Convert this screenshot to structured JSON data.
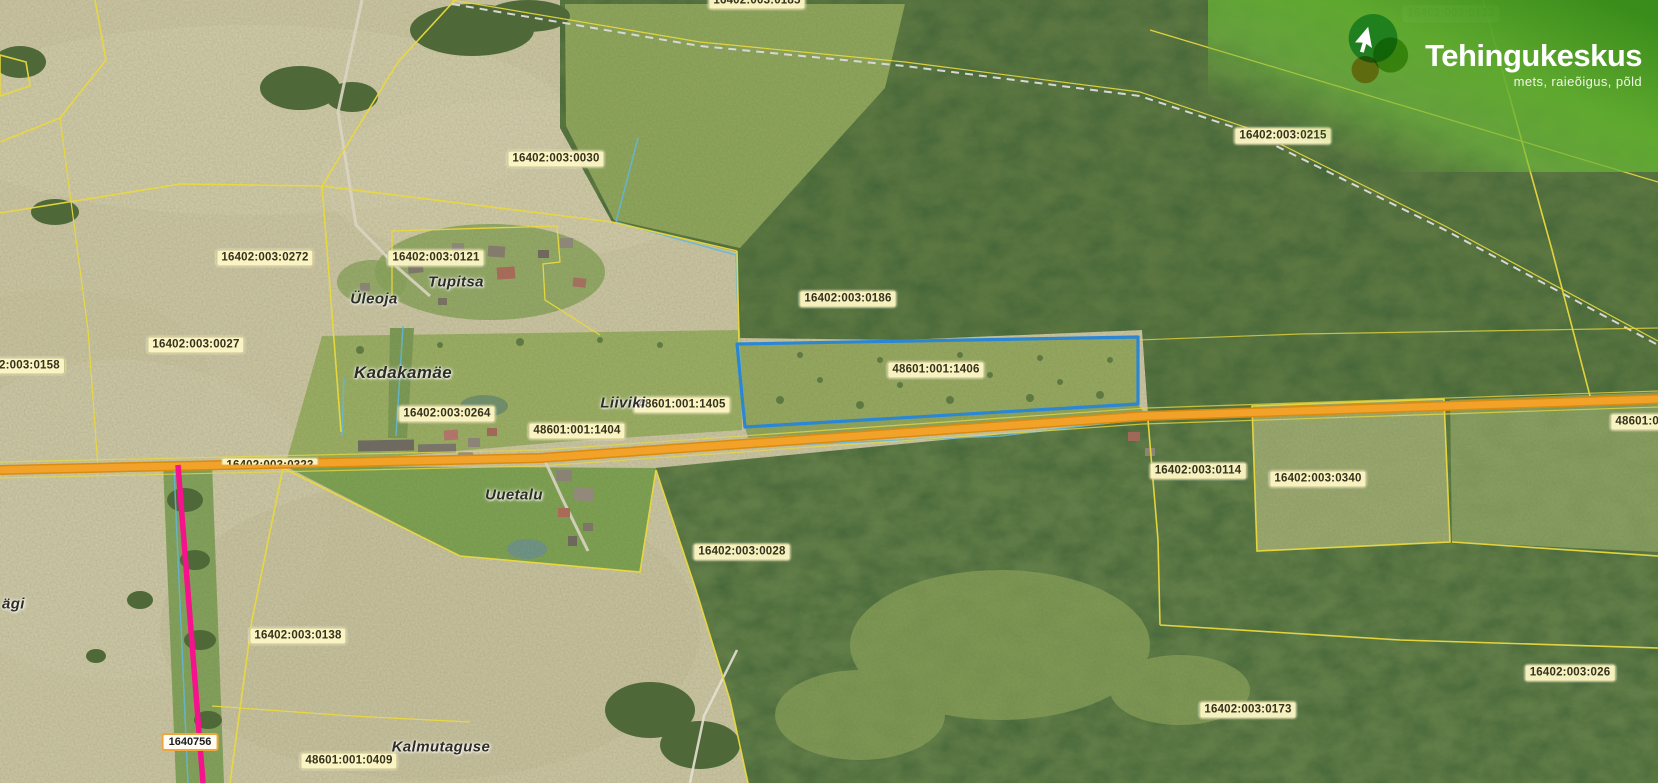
{
  "brand": {
    "name": "Tehingukeskus",
    "tagline": "mets, raieõigus, põld",
    "logo_icon": "cursor-in-circles",
    "logo_colors": {
      "teal": "#54c39a",
      "green": "#8fc93f",
      "orange": "#f2a93b"
    }
  },
  "labels": {
    "parcels": [
      {
        "text": "16402:003:0185",
        "x": 757,
        "y": 1,
        "v": "cut-top"
      },
      {
        "text": "16402:003:0133",
        "x": 1451,
        "y": 14,
        "v": "faded"
      },
      {
        "text": "16402:003:0215",
        "x": 1283,
        "y": 136
      },
      {
        "text": "16402:003:0030",
        "x": 556,
        "y": 159
      },
      {
        "text": "16402:003:0272",
        "x": 265,
        "y": 258
      },
      {
        "text": "16402:003:0121",
        "x": 436,
        "y": 258
      },
      {
        "text": "16402:003:0186",
        "x": 848,
        "y": 299
      },
      {
        "text": "16402:003:0027",
        "x": 196,
        "y": 345
      },
      {
        "text": "2:003:0158",
        "x": -6,
        "y": 366,
        "v": "cut-left"
      },
      {
        "text": "16402:003:0264",
        "x": 447,
        "y": 414
      },
      {
        "text": "48601:001:1405",
        "x": 682,
        "y": 405
      },
      {
        "text": "48601:001:1404",
        "x": 577,
        "y": 431
      },
      {
        "text": "48601:001:1406",
        "x": 936,
        "y": 370
      },
      {
        "text": "48601:0",
        "x": 1664,
        "y": 422,
        "v": "cut-right"
      },
      {
        "text": "16402:003:0323",
        "x": 270,
        "y": 466,
        "v": "under-road"
      },
      {
        "text": "16402:003:0114",
        "x": 1198,
        "y": 471
      },
      {
        "text": "16402:003:0340",
        "x": 1318,
        "y": 479
      },
      {
        "text": "16402:003:0028",
        "x": 742,
        "y": 552
      },
      {
        "text": "16402:003:0138",
        "x": 298,
        "y": 636
      },
      {
        "text": "16402:003:0173",
        "x": 1248,
        "y": 710
      },
      {
        "text": "16402:003:026",
        "x": 1570,
        "y": 673
      },
      {
        "text": "48601:001:0409",
        "x": 349,
        "y": 761
      }
    ],
    "places": [
      {
        "text": "Üleoja",
        "x": 374,
        "y": 299
      },
      {
        "text": "Tupitsa",
        "x": 456,
        "y": 282
      },
      {
        "text": "Kadakamäe",
        "x": 403,
        "y": 373,
        "size": 17
      },
      {
        "text": "Liiviki",
        "x": 623,
        "y": 403
      },
      {
        "text": "Uuetalu",
        "x": 514,
        "y": 495
      },
      {
        "text": "Kalmutaguse",
        "x": 441,
        "y": 747
      },
      {
        "text": "ägi",
        "x": 2,
        "y": 604,
        "v": "cut-left"
      }
    ],
    "road_badge": {
      "text": "1640756",
      "x": 190,
      "y": 742
    }
  },
  "highlight": {
    "parcel": "48601:001:1406",
    "outline_color": "#2b87d3"
  },
  "map_colors": {
    "boundary_yellow": "#ead93f",
    "road_orange": "#f2a228",
    "powerline_magenta": "#f5128c",
    "water_blue": "#62b7dd",
    "field_tan": "#cfc8a5",
    "forest_green": "#5d7a42"
  }
}
